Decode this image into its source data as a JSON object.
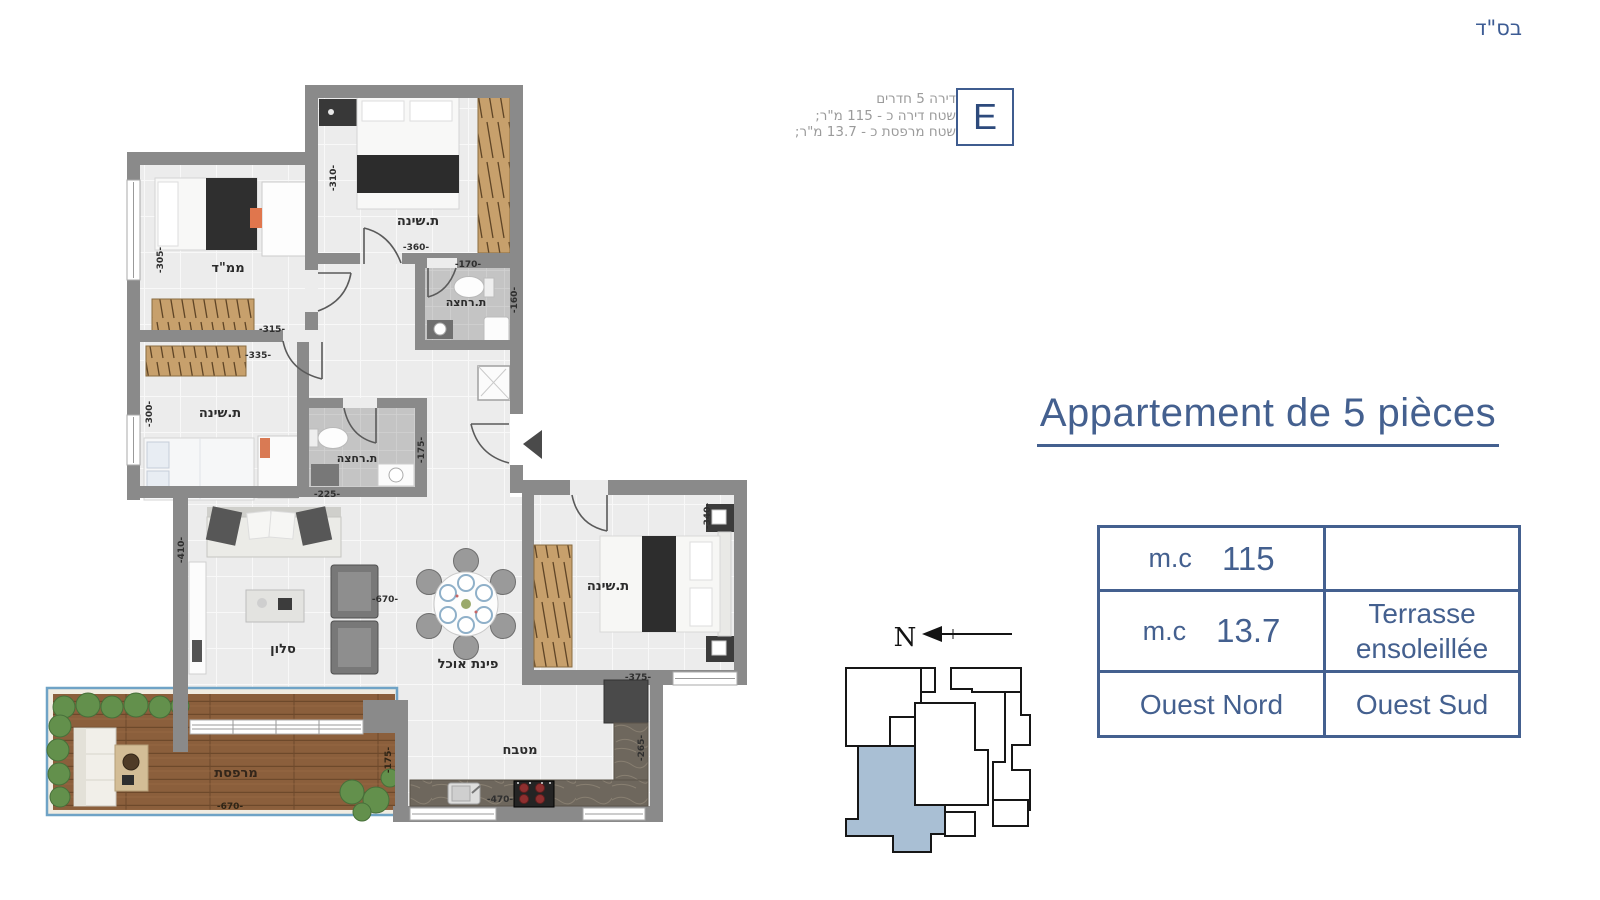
{
  "header": {
    "bsd": "בס\"ד"
  },
  "unit_badge": {
    "letter": "E",
    "info_lines": [
      "דירה 5 חדרים",
      "שטח דירה כ - 115 מ\"ר;",
      "שטח מרפסת כ - 13.7 מ\"ר;"
    ]
  },
  "listing": {
    "title": "Appartement de 5 pièces",
    "table": {
      "area_label": "m.c",
      "area_value": "115",
      "area_note": "",
      "terrace_label": "m.c",
      "terrace_value": "13.7",
      "terrace_name": "Terrasse ensoleillée",
      "orientation_left": "Ouest Nord",
      "orientation_right": "Ouest Sud"
    }
  },
  "compass": {
    "north_label": "N"
  },
  "plan": {
    "rooms": {
      "mamad": "ממ\"ד",
      "bedroom_top": "ת.שינה",
      "bedroom_left": "ת.שינה",
      "bedroom_right": "ת.שינה",
      "bathroom_top": "ת.רחצה",
      "bathroom_mid": "ת.רחצה",
      "salon": "סלון",
      "dining": "פינת אוכל",
      "kitchen": "מטבח",
      "terrace": "מרפסת"
    },
    "dims": {
      "bedroom_top_h": "-310-",
      "bedroom_top_w": "-360-",
      "mamad_h": "-305-",
      "mamad_w": "-315-",
      "bedroom_left_w": "-335-",
      "bedroom_left_h": "-300-",
      "bathroom_top_w": "-170-",
      "bathroom_top_h": "-160-",
      "bathroom_mid_w": "-225-",
      "bathroom_mid_h": "-175-",
      "salon_h": "-410-",
      "salon_w": "-670-",
      "bedroom_right_h": "-340-",
      "bedroom_right_w": "-375-",
      "kitchen_h": "-265-",
      "kitchen_w": "-470-",
      "terrace_w": "-670-",
      "terrace_h": "-175-"
    }
  },
  "colors": {
    "accent_blue": "#44608f",
    "annotation_gray": "#9b9b9b",
    "wall_gray": "#8a8a8a",
    "keyplan_highlight": "#a9bfd4",
    "wood": "#c7a06c",
    "deck": "#8b5f3c"
  }
}
